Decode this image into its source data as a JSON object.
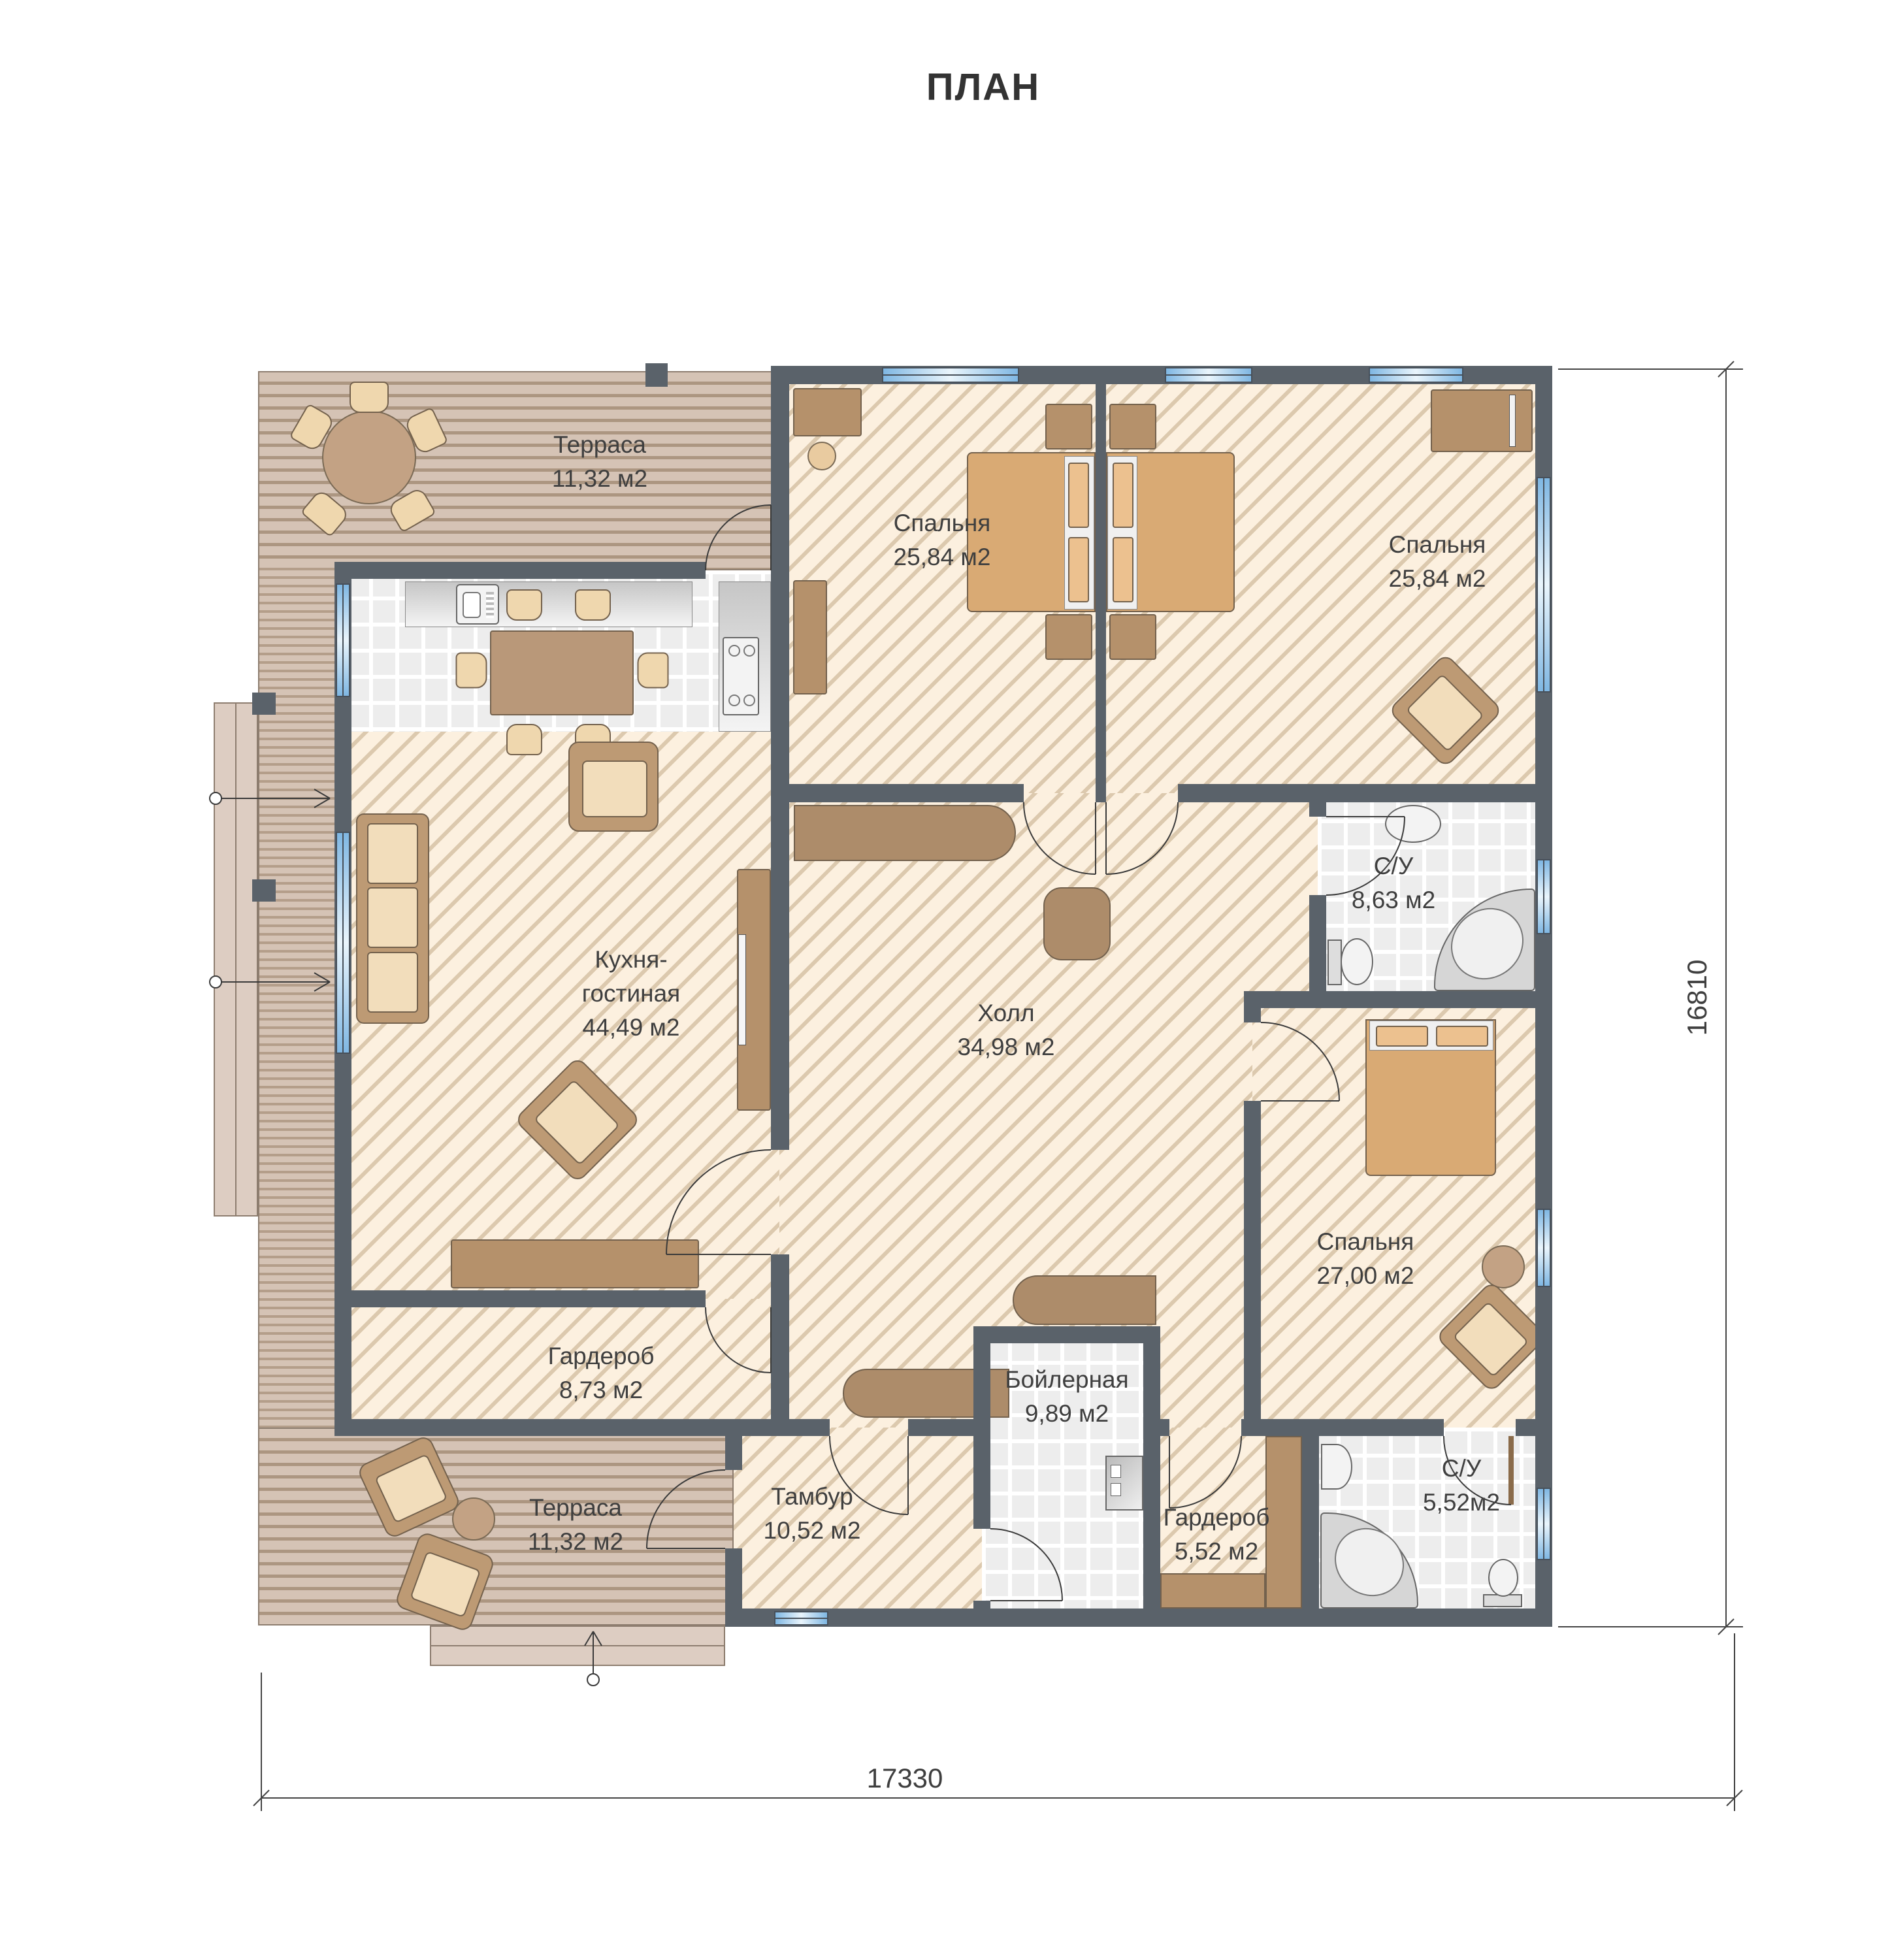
{
  "title": "ПЛАН",
  "rooms": {
    "terrace_top": {
      "lines": [
        "Терраса",
        "11,32 м2"
      ]
    },
    "bedroom_1": {
      "lines": [
        "Спальня",
        "25,84 м2"
      ]
    },
    "bedroom_2": {
      "lines": [
        "Спальня",
        "25,84 м2"
      ]
    },
    "kitchen_living": {
      "lines": [
        "Кухня-",
        "гостиная",
        "44,49 м2"
      ]
    },
    "hall": {
      "lines": [
        "Холл",
        "34,98 м2"
      ]
    },
    "bathroom_1": {
      "lines": [
        "С/У",
        "8,63 м2"
      ]
    },
    "bedroom_3": {
      "lines": [
        "Спальня",
        "27,00 м2"
      ]
    },
    "wardrobe_1": {
      "lines": [
        "Гардероб",
        "8,73 м2"
      ]
    },
    "terrace_bottom": {
      "lines": [
        "Терраса",
        "11,32 м2"
      ]
    },
    "tambour": {
      "lines": [
        "Тамбур",
        "10,52 м2"
      ]
    },
    "boiler": {
      "lines": [
        "Бойлерная",
        "9,89 м2"
      ]
    },
    "wardrobe_2": {
      "lines": [
        "Гардероб",
        "5,52 м2"
      ]
    },
    "bathroom_2": {
      "lines": [
        "С/У",
        "5,52м2"
      ]
    }
  },
  "dimensions": {
    "bottom": "17330",
    "right": "16810"
  },
  "colors": {
    "wall": "#5a626a",
    "hatch_bg": "#fcf0df",
    "hatch_line": "#dcc9ae",
    "deck_bg": "#d5c3b5",
    "deck_line": "#b49e8a",
    "tile_bg": "#ededed",
    "window": "#7fb7e3",
    "furniture": "#b5916b",
    "bed": "#d9aa74"
  }
}
